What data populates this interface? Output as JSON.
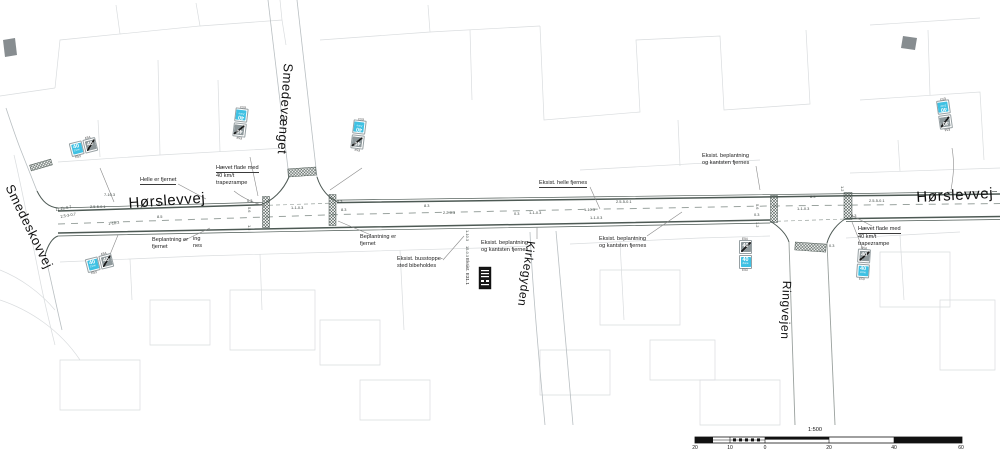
{
  "drawing": {
    "scale_label": "1:500",
    "scalebar_ticks": [
      {
        "t": "20",
        "x": 695
      },
      {
        "t": "10",
        "x": 730
      },
      {
        "t": "0",
        "x": 765
      },
      {
        "t": "20",
        "x": 829
      },
      {
        "t": "40",
        "x": 894
      },
      {
        "t": "60",
        "x": 961
      }
    ],
    "street_labels": [
      {
        "t": "Hørslevvej",
        "x": 128,
        "y": 195,
        "rot": -4,
        "size": 15
      },
      {
        "t": "Hørslevvej",
        "x": 916,
        "y": 189,
        "rot": -3,
        "size": 15
      },
      {
        "t": "Smedeskovvej",
        "x": 16,
        "y": 182,
        "rot": 64,
        "size": 13
      },
      {
        "t": "Smedevænget",
        "x": 296,
        "y": 64,
        "rot": 94,
        "size": 13
      },
      {
        "t": "Kirkegyden",
        "x": 538,
        "y": 242,
        "rot": 98,
        "size": 12
      },
      {
        "t": "Ringvejen",
        "x": 794,
        "y": 281,
        "rot": 92,
        "size": 12
      }
    ],
    "annotations": [
      {
        "l1": "Helle er fjernet",
        "l2": "",
        "l3": "",
        "x": 140,
        "y": 177,
        "cls": "u1"
      },
      {
        "l1": "Hævet flade med",
        "l2": "40 km/t",
        "l3": "trapezrampe",
        "x": 216,
        "y": 165,
        "cls": "u1"
      },
      {
        "l1": "Beplantning er",
        "l2": "fjernet",
        "l3": "",
        "x": 152,
        "y": 237,
        "cls": ""
      },
      {
        "l1": "ing",
        "l2": "nes",
        "l3": "",
        "x": 193,
        "y": 236,
        "cls": ""
      },
      {
        "l1": "Beplantning er",
        "l2": "fjernet",
        "l3": "",
        "x": 360,
        "y": 234,
        "cls": ""
      },
      {
        "l1": "Eksist. busstoppe-",
        "l2": "sted bibeholdes",
        "l3": "",
        "x": 397,
        "y": 256,
        "cls": ""
      },
      {
        "l1": "Eksist. beplantning",
        "l2": "og kantsten fjernes",
        "l3": "",
        "x": 481,
        "y": 240,
        "cls": ""
      },
      {
        "l1": "Eksist. helle fjernes",
        "l2": "",
        "l3": "",
        "x": 539,
        "y": 180,
        "cls": "u1"
      },
      {
        "l1": "Eksist. beplantning",
        "l2": "og kantsten fjernes",
        "l3": "",
        "x": 599,
        "y": 236,
        "cls": ""
      },
      {
        "l1": "Eksist. beplantning",
        "l2": "og kantsten fjernes",
        "l3": "",
        "x": 702,
        "y": 153,
        "cls": ""
      },
      {
        "l1": "Hævet flade med",
        "l2": "40 km/t",
        "l3": "trapezrampe",
        "x": 858,
        "y": 226,
        "cls": "u1"
      }
    ],
    "dimensions": [
      {
        "t": "7-10.3",
        "x": 104,
        "y": 192,
        "rot": 0
      },
      {
        "t": "2.5-5-0.1",
        "x": 90,
        "y": 204,
        "rot": 0
      },
      {
        "t": "11.2b-0.7",
        "x": 55,
        "y": 207,
        "rot": -10
      },
      {
        "t": "2.5-3-0.7",
        "x": 60,
        "y": 214,
        "rot": -10
      },
      {
        "t": "1-10.3",
        "x": 108,
        "y": 221,
        "rot": -6
      },
      {
        "t": "8.3",
        "x": 158,
        "y": 201,
        "rot": 0
      },
      {
        "t": "8.5",
        "x": 157,
        "y": 214,
        "rot": 0
      },
      {
        "t": "0.3",
        "x": 247,
        "y": 198,
        "rot": 0
      },
      {
        "t": "5.6",
        "x": 252,
        "y": 207,
        "rot": 90
      },
      {
        "t": "1.2",
        "x": 252,
        "y": 225,
        "rot": 90
      },
      {
        "t": "1-1-0.3",
        "x": 291,
        "y": 205,
        "rot": 0
      },
      {
        "t": "0.3",
        "x": 337,
        "y": 199,
        "rot": 0
      },
      {
        "t": "8.3",
        "x": 341,
        "y": 207,
        "rot": 0
      },
      {
        "t": "8.3",
        "x": 424,
        "y": 203,
        "rot": 0
      },
      {
        "t": "2.2-0.3",
        "x": 443,
        "y": 210,
        "rot": 0
      },
      {
        "t": "0.3",
        "x": 514,
        "y": 211,
        "rot": 0
      },
      {
        "t": "1-1-0.3",
        "x": 529,
        "y": 210,
        "rot": 0
      },
      {
        "t": "1-10.3",
        "x": 584,
        "y": 207,
        "rot": 0
      },
      {
        "t": "1-1-0.3",
        "x": 590,
        "y": 215,
        "rot": 0
      },
      {
        "t": "2.5-5-0.1",
        "x": 616,
        "y": 199,
        "rot": 0
      },
      {
        "t": "1-10.3",
        "x": 470,
        "y": 230,
        "rot": 90
      },
      {
        "t": "15-0.3",
        "x": 470,
        "y": 246,
        "rot": 90
      },
      {
        "t": "0.3",
        "x": 754,
        "y": 212,
        "rot": 0
      },
      {
        "t": "5.6",
        "x": 760,
        "y": 204,
        "rot": 90
      },
      {
        "t": "1.2",
        "x": 760,
        "y": 222,
        "rot": 90
      },
      {
        "t": "1-1-0.3",
        "x": 797,
        "y": 206,
        "rot": 0
      },
      {
        "t": "8.3",
        "x": 810,
        "y": 194,
        "rot": 0
      },
      {
        "t": "0.3",
        "x": 829,
        "y": 243,
        "rot": 0
      },
      {
        "t": "0.3",
        "x": 851,
        "y": 213,
        "rot": 0
      },
      {
        "t": "2.5-5-0.1",
        "x": 869,
        "y": 198,
        "rot": 0
      },
      {
        "t": "1.2",
        "x": 845,
        "y": 186,
        "rot": 90
      }
    ],
    "sign_pairs": [
      {
        "x": 70,
        "y": 140,
        "rot": -14,
        "cls": "h"
      },
      {
        "x": 86,
        "y": 256,
        "rot": -14,
        "cls": "h"
      },
      {
        "x": 234,
        "y": 108,
        "rot": 187,
        "cls": "vr"
      },
      {
        "x": 352,
        "y": 120,
        "rot": 187,
        "cls": "vr"
      },
      {
        "x": 739,
        "y": 240,
        "rot": 0,
        "cls": "vr"
      },
      {
        "x": 857,
        "y": 249,
        "rot": 4,
        "cls": "vr"
      },
      {
        "x": 938,
        "y": 100,
        "rot": 172,
        "cls": "vr"
      }
    ],
    "signs": {
      "speed": "40",
      "zone_word": "Zone",
      "zone_code": "E53",
      "end_code": "E54"
    },
    "bus_stop": {
      "label": "Eksist. E31.1"
    },
    "colors": {
      "sign_blue": "#3fc1e3",
      "road_line": "#4d5954",
      "faint_line": "#d9dcde"
    }
  }
}
